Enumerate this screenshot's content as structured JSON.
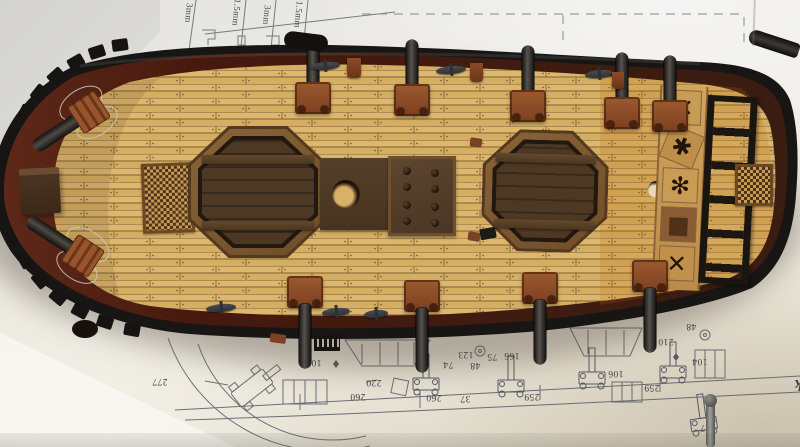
{
  "plan": {
    "title": {
      "line1": "Main Deck",
      "line2": "Layout"
    },
    "pin_labels": [
      "3mm",
      "Ø1.5mm",
      "3mm",
      "Ø1.5mm"
    ],
    "dims": [
      "277",
      "105",
      "220",
      "260",
      "260",
      "37",
      "74",
      "123",
      "48",
      "75",
      "166",
      "259",
      "259",
      "210",
      "104",
      "106",
      "48",
      "117"
    ]
  },
  "ship": {
    "panel_glyphs": [
      "✕",
      "✱",
      "✻",
      "■",
      "✕"
    ]
  },
  "colors": {
    "deck_plank": "#d9b469",
    "deck_seam": "#7e623a",
    "hull_black": "#181615",
    "bulwark_maroon": "#5c2617",
    "hatch_frame": "#7d5a33",
    "hatch_well": "#3c2c1d",
    "carriage_red": "#8a4a28",
    "barrel_gray": "#2e2c2a",
    "grating_light": "#c59a55",
    "grating_dark": "#4e3117",
    "paper": "#edebe4",
    "plan_ink": "#565a63"
  }
}
